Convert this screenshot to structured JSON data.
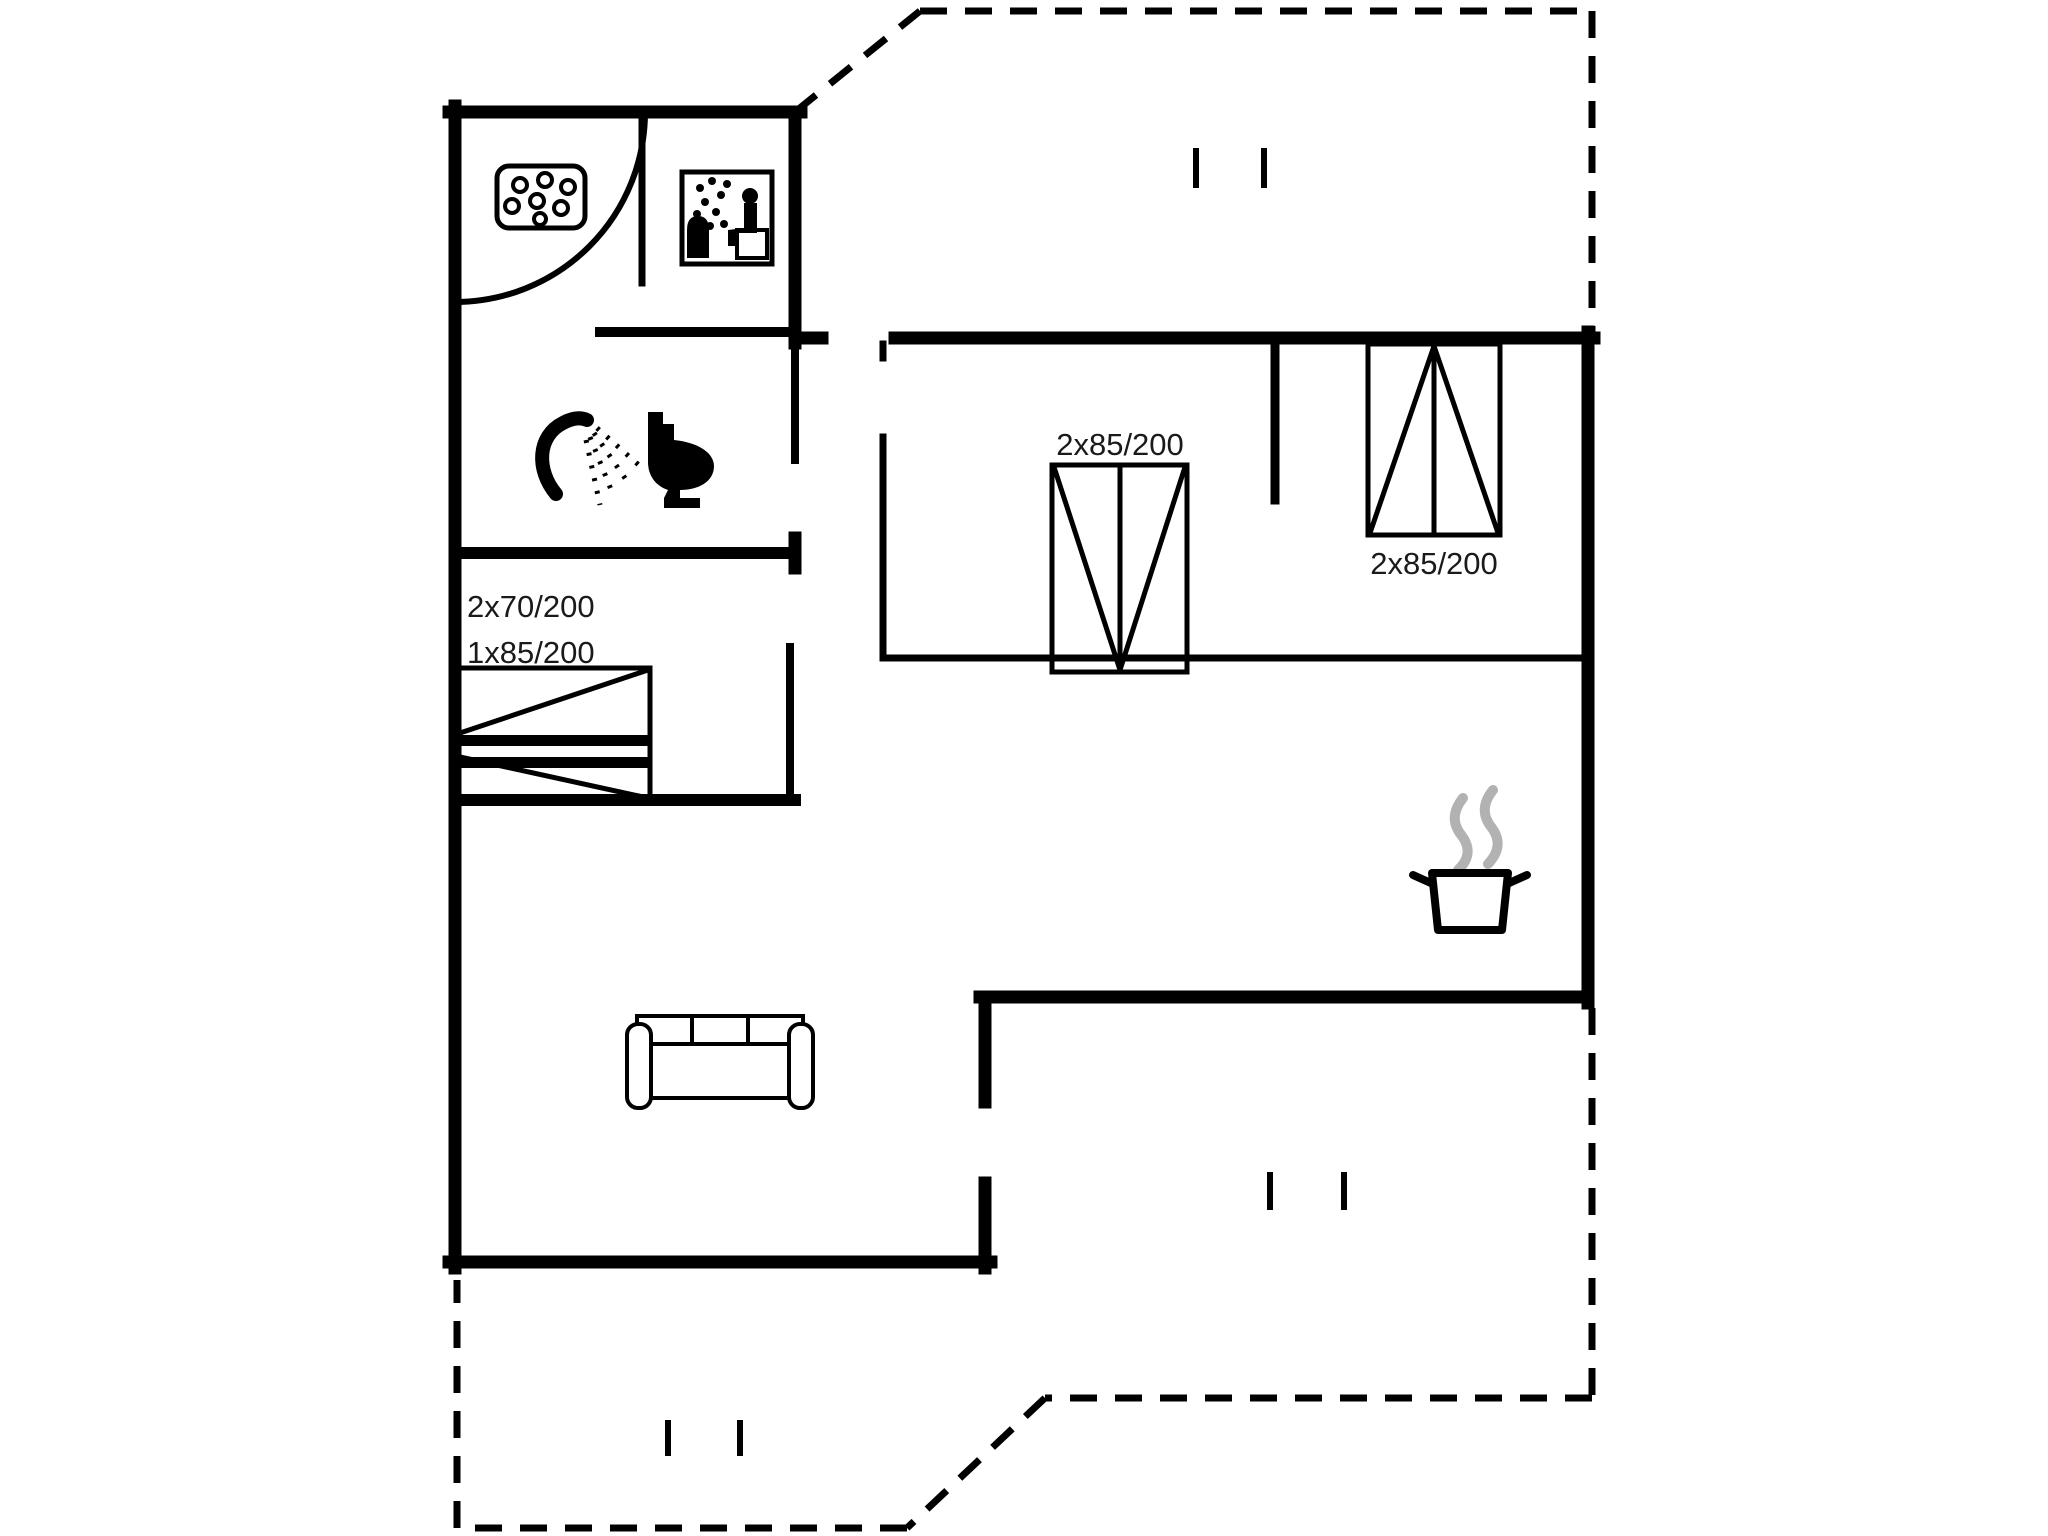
{
  "plan": {
    "type": "floor-plan",
    "background_color": "#ffffff",
    "wall_color": "#000000",
    "steam_color": "#b2b2b2",
    "labels": {
      "bunk_room_line1": "2x70/200",
      "bunk_room_line2": "1x85/200",
      "bedroom_middle_bed": "2x85/200",
      "bedroom_right_bed": "2x85/200"
    },
    "rooms": [
      "whirlpool-room",
      "sauna",
      "bathroom-shower-toilet",
      "bunk-bedroom",
      "bedroom-middle",
      "bedroom-right",
      "hallway",
      "living-kitchen-area",
      "terrace-top",
      "terrace-bottom"
    ],
    "icons": [
      "whirlpool-icon",
      "sauna-icon",
      "shower-icon",
      "toilet-icon",
      "bunk-bed-icon",
      "double-bed-icon",
      "double-bed-icon",
      "sofa-icon",
      "cooking-pot-icon"
    ]
  }
}
